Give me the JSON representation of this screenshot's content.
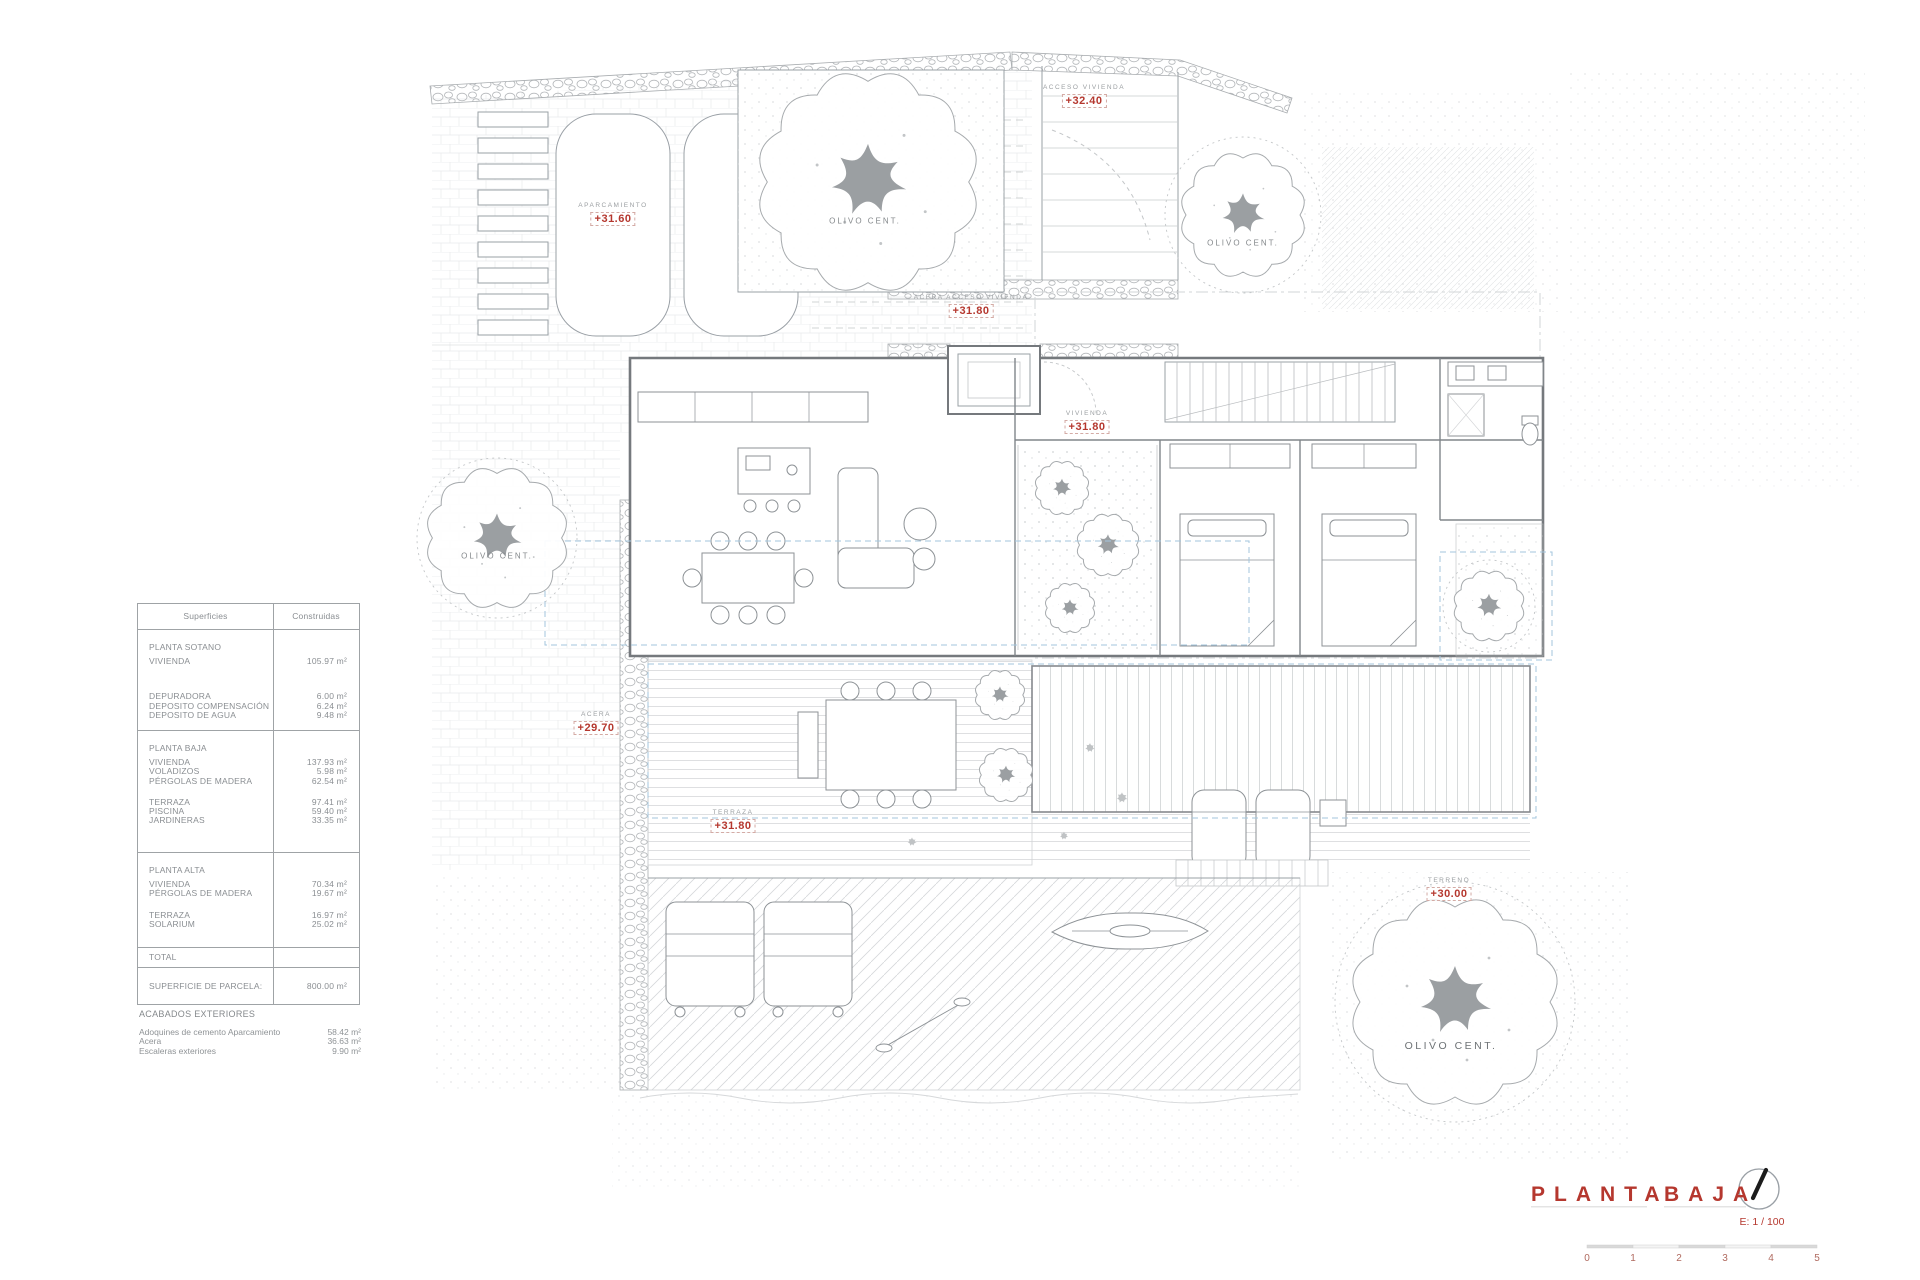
{
  "colors": {
    "accent": "#b5372e"
  },
  "surfaces_table": {
    "header": {
      "surfaces": "Superficies",
      "built": "Construidas"
    },
    "rows": [
      {
        "label": "PLANTA SOTANO",
        "value": ""
      },
      {
        "label": "VIVIENDA",
        "value": "105.97 m²"
      },
      {
        "label": "DEPURADORA",
        "value": "6.00 m²"
      },
      {
        "label": "DEPOSITO COMPENSACIÓN",
        "value": "6.24 m²"
      },
      {
        "label": "DEPOSITO DE AGUA",
        "value": "9.48 m²"
      },
      {
        "label": "PLANTA BAJA",
        "value": ""
      },
      {
        "label": "VIVIENDA",
        "value": "137.93 m²"
      },
      {
        "label": "VOLADIZOS",
        "value": "5.98 m²"
      },
      {
        "label": "PÉRGOLAS DE MADERA",
        "value": "62.54 m²"
      },
      {
        "label": "TERRAZA",
        "value": "97.41 m²"
      },
      {
        "label": "PISCINA",
        "value": "59.40 m²"
      },
      {
        "label": "JARDINERAS",
        "value": "33.35 m²"
      },
      {
        "label": "PLANTA ALTA",
        "value": ""
      },
      {
        "label": "VIVIENDA",
        "value": "70.34 m²"
      },
      {
        "label": "PÉRGOLAS DE MADERA",
        "value": "19.67 m²"
      },
      {
        "label": "TERRAZA",
        "value": "16.97 m²"
      },
      {
        "label": "SOLARIUM",
        "value": "25.02 m²"
      },
      {
        "label": "TOTAL",
        "value": ""
      },
      {
        "label": "SUPERFICIE DE PARCELA:",
        "value": "800.00 m²"
      }
    ]
  },
  "exterior_finishes": {
    "title": "ACABADOS EXTERIORES",
    "items": [
      {
        "label": "Adoquines de cemento Aparcamiento",
        "value": "58.42 m²"
      },
      {
        "label": "Acera",
        "value": "36.63 m²"
      },
      {
        "label": "Escaleras exteriores",
        "value": "9.90 m²"
      }
    ]
  },
  "plan_labels": {
    "aparcamiento": {
      "name": "APARCAMIENTO",
      "elevation": "+31.60"
    },
    "acceso_vivienda": {
      "name": "ACCESO VIVIENDA",
      "elevation": "+32.40"
    },
    "acera_acceso": {
      "name": "ACERA ACCESO VIVIENDA",
      "elevation": "+31.80"
    },
    "vivienda": {
      "name": "VIVIENDA",
      "elevation": "+31.80"
    },
    "acera": {
      "name": "ACERA",
      "elevation": "+29.70"
    },
    "terraza": {
      "name": "TERRAZA",
      "elevation": "+31.80"
    },
    "terreno": {
      "name": "TERRENO",
      "elevation": "+30.00"
    },
    "olive_tree": "OLIVO CENT."
  },
  "title_block": {
    "title_word1": "PLANTA",
    "title_word2": "BAJA",
    "scale": "E: 1 / 100"
  },
  "scale_bar": {
    "ticks": [
      "0",
      "1",
      "2",
      "3",
      "4",
      "5"
    ]
  }
}
